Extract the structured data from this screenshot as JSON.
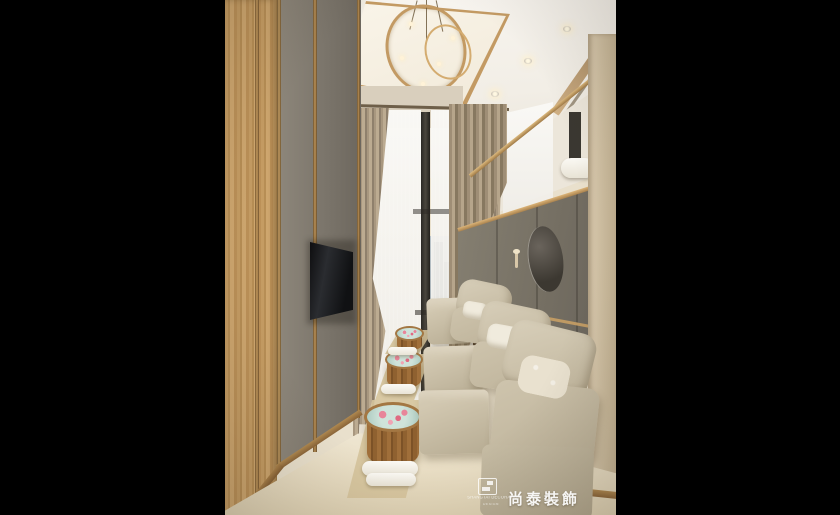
{
  "watermark": {
    "brand_chinese": "尚泰裝飾",
    "brand_english_line1": "SHANGTAI DECORATION",
    "brand_english_line2": "DESIGN",
    "logo_icon": "shangtai-logo-icon"
  },
  "palette": {
    "backdrop": "#000000",
    "wood": "#c49a63",
    "brass": "#c39a63",
    "wall_gray": "#7a746a",
    "ceiling": "#f4f0e9",
    "drape": "#a8977f",
    "sheer": "#f3f1ee",
    "chair": "#cbc1ab",
    "floor": "#e9e0cc",
    "basin_wood": "#8f6130",
    "water": "#cfe3da",
    "petal": "#e8859a",
    "city": "#aab3b8"
  }
}
